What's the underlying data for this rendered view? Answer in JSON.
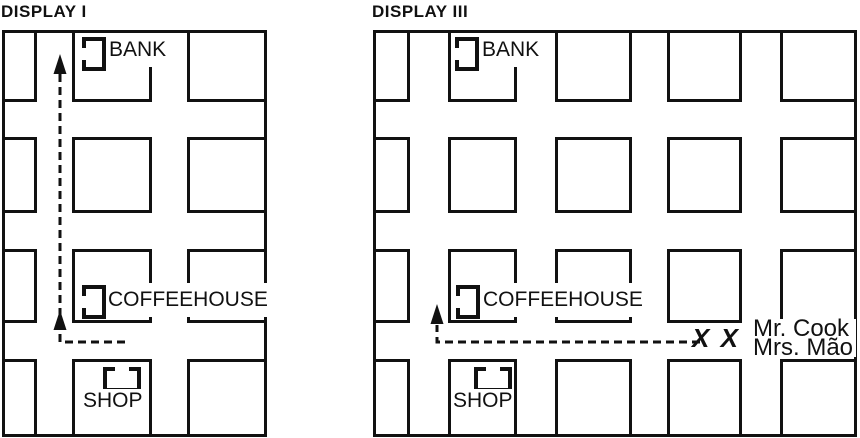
{
  "display1": {
    "title": "DISPLAY I",
    "bank": "BANK",
    "coffeehouse": "COFFEEHOUSE",
    "shop": "SHOP"
  },
  "display3": {
    "title": "DISPLAY III",
    "bank": "BANK",
    "coffeehouse": "COFFEEHOUSE",
    "shop": "SHOP",
    "x_marks": "X X",
    "people": [
      "Mr. Cook",
      "Mrs. Mão"
    ]
  },
  "colors": {
    "ink": "#111111",
    "paper": "#ffffff"
  }
}
